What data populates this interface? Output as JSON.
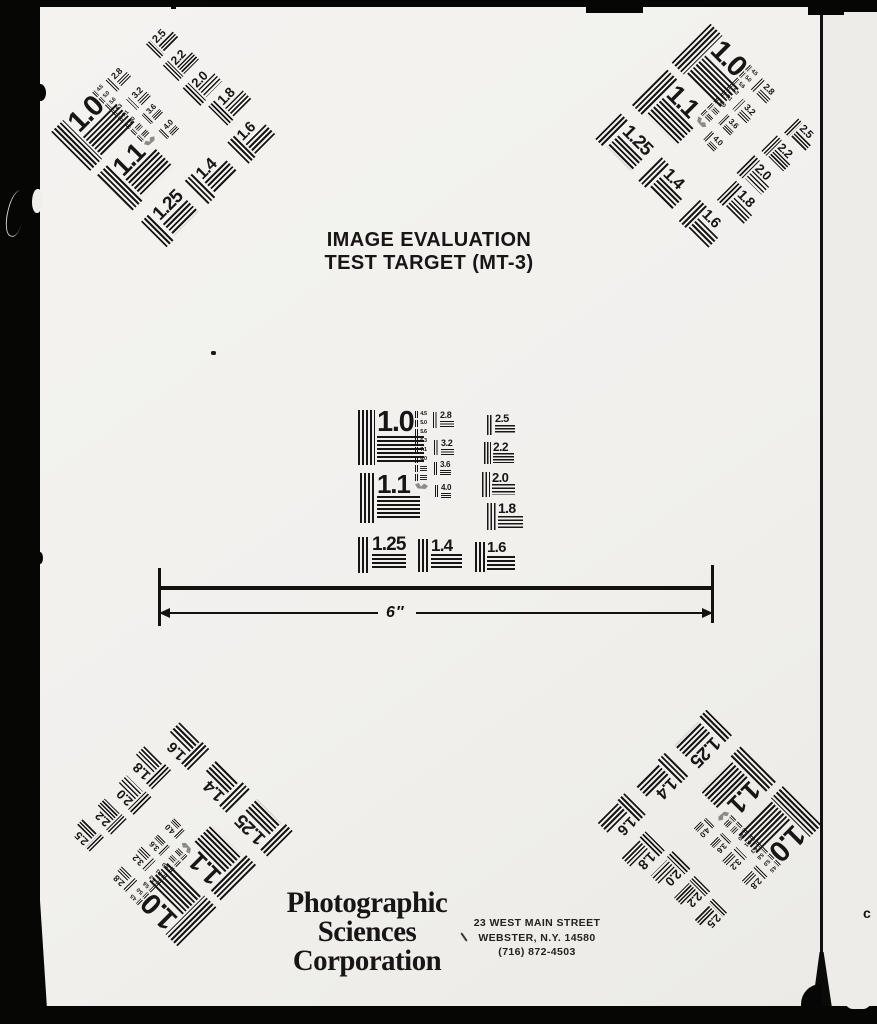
{
  "document": {
    "title_line1": "IMAGE EVALUATION",
    "title_line2": "TEST TARGET (MT-3)"
  },
  "pattern": {
    "labels": {
      "r10": "1.0",
      "r11": "1.1",
      "r125": "1.25",
      "r14": "1.4",
      "r16": "1.6",
      "r18": "1.8",
      "r20": "2.0",
      "r22": "2.2",
      "r25": "2.5",
      "r28": "2.8",
      "r32": "3.2",
      "r36": "3.6",
      "r40": "4.0"
    },
    "micro": [
      "4.5",
      "5.0",
      "5.6",
      "6.3",
      "7.1",
      "8.0"
    ]
  },
  "ruler": {
    "label": "6″"
  },
  "footer": {
    "company": [
      "Photographic",
      "Sciences",
      "Corporation"
    ],
    "address": [
      "23 WEST MAIN STREET",
      "WEBSTER, N.Y. 14580",
      "(716) 872-4503"
    ]
  },
  "edge": {
    "letter": "c"
  },
  "colors": {
    "ink": "#181614",
    "paper": "#f2f1ee",
    "film": "#060605"
  }
}
